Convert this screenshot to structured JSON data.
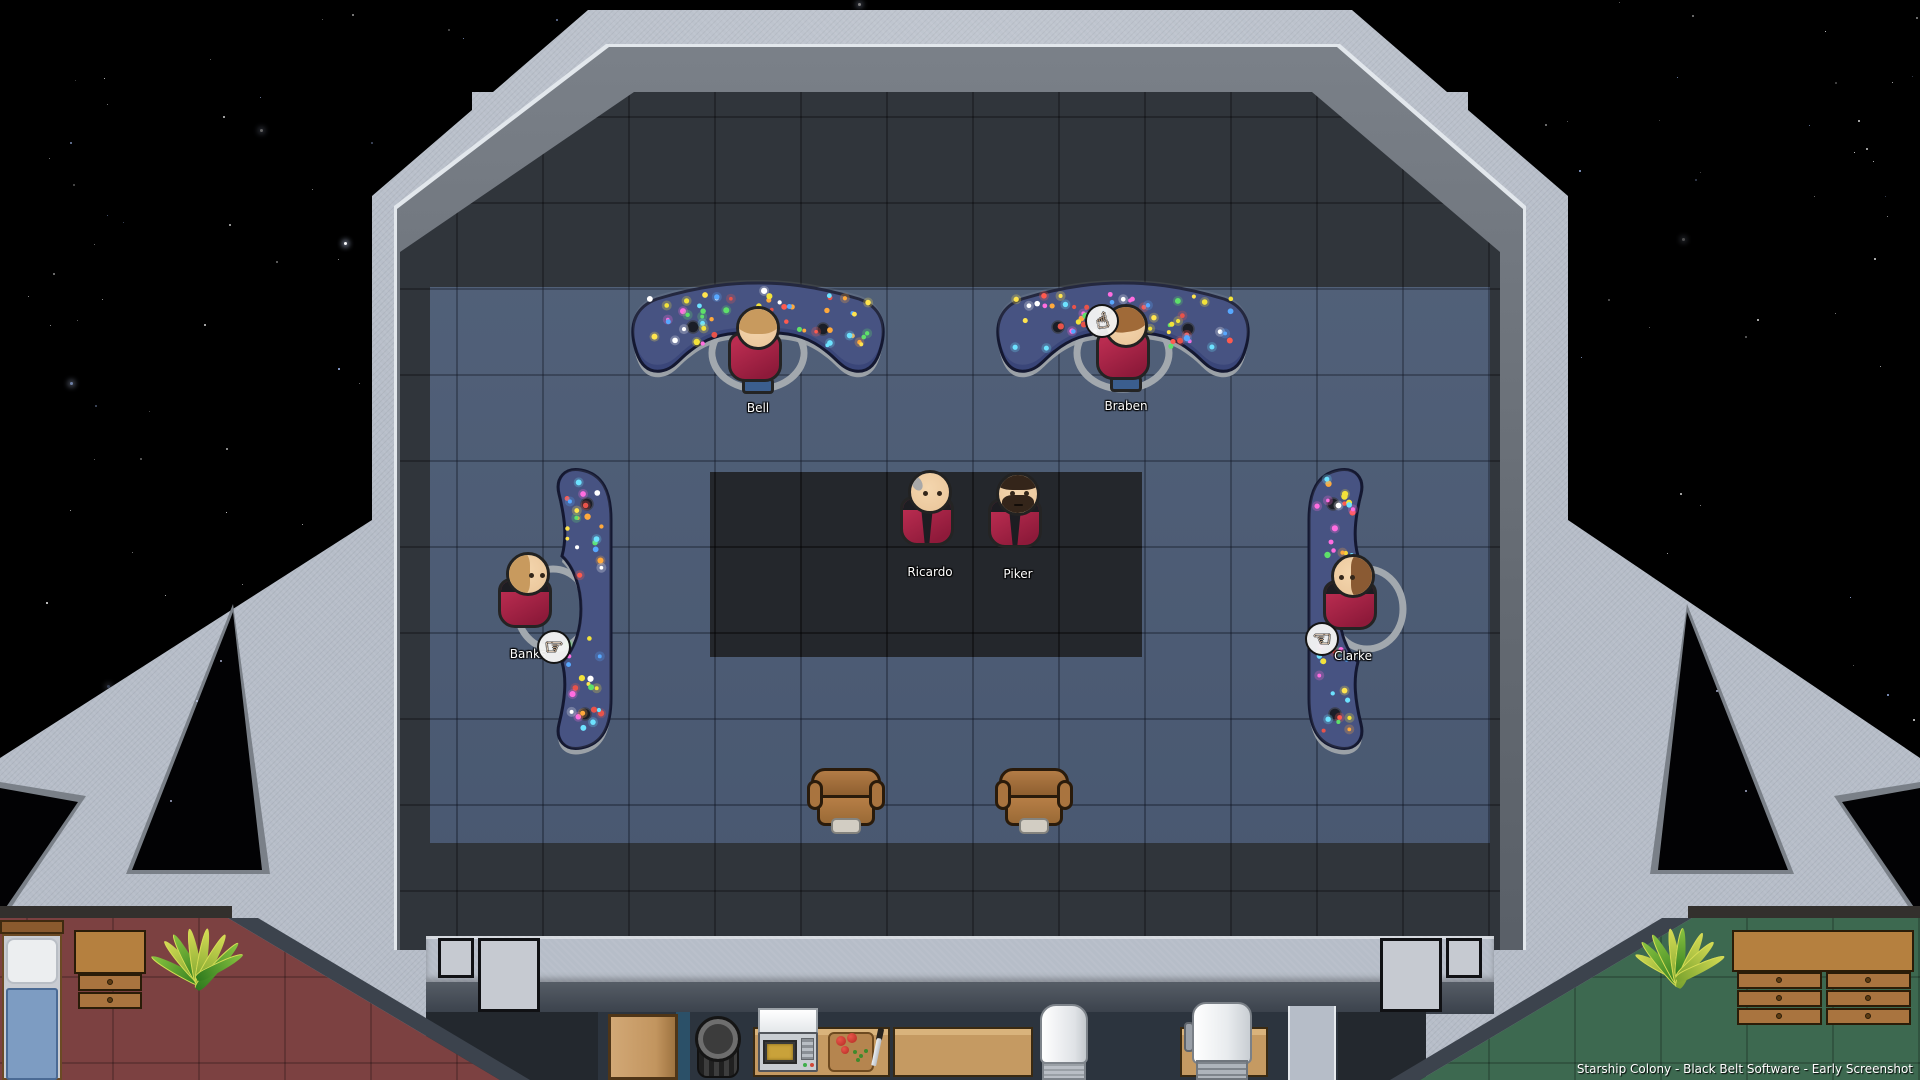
{
  "caption": "Starship Colony - Black Belt Software - Early Screenshot",
  "crew": [
    {
      "name": "Bell",
      "facing": "away",
      "hair_color": "#c89a5e",
      "pants_color": "#3b5e8e",
      "station": "helm-console-left",
      "pos": {
        "x": 758,
        "y": 306
      }
    },
    {
      "name": "Braben",
      "facing": "away",
      "hair_color": "#a06a38",
      "pants_color": "#3b5e8e",
      "station": "helm-console-right",
      "pos": {
        "x": 1126,
        "y": 304
      }
    },
    {
      "name": "Ricardo",
      "facing": "front",
      "hair_color": "bald",
      "hair_accent": "#a8a8a8",
      "station": "command-platform",
      "pos": {
        "x": 930,
        "y": 470
      }
    },
    {
      "name": "Piker",
      "facing": "front",
      "hair_color": "#34251a",
      "beard": true,
      "station": "command-platform",
      "pos": {
        "x": 1018,
        "y": 472
      }
    },
    {
      "name": "Banks",
      "facing": "right",
      "hair_color": "#c89a5e",
      "station": "side-console-left",
      "pos": {
        "x": 528,
        "y": 552
      }
    },
    {
      "name": "Clarke",
      "facing": "left",
      "hair_color": "#8a5a33",
      "station": "side-console-right",
      "pos": {
        "x": 1353,
        "y": 554
      }
    }
  ],
  "cursors": [
    {
      "icon": "hand-pointing-up",
      "glyph": "☝",
      "attached_to": "Braben",
      "pos": {
        "x": 1102,
        "y": 321
      }
    },
    {
      "icon": "hand-pointing-right",
      "glyph": "☞",
      "attached_to": "Banks",
      "pos": {
        "x": 554,
        "y": 647
      }
    },
    {
      "icon": "hand-pointing-left",
      "glyph": "☜",
      "attached_to": "Clarke",
      "pos": {
        "x": 1322,
        "y": 639
      }
    }
  ],
  "colors": {
    "space": "#000000",
    "hull": "#b6bdc8",
    "floor_dark": "#30353b",
    "floor_blue": "#4a5a74",
    "platform": "#24272c",
    "console_blue": "#3a4679",
    "uniform_red": "#9e2044",
    "bedroom_red_floor": "#7c4141",
    "bedroom_green_floor": "#3d6950",
    "wood": "#c59a62",
    "chair_brown": "#a9743f"
  },
  "furniture": {
    "bridge": [
      "helm-console-left",
      "helm-console-right",
      "side-console-left",
      "side-console-right",
      "captain-chair-left",
      "captain-chair-right"
    ],
    "kitchen": [
      "door",
      "waste-bin",
      "counter",
      "microwave",
      "cutting-board",
      "knife",
      "counter",
      "paper-towel-unit",
      "counter",
      "water-heater"
    ],
    "bedroom_left": [
      "bed",
      "dresser",
      "potted-plant"
    ],
    "bedroom_right": [
      "potted-plant",
      "dresser"
    ]
  }
}
